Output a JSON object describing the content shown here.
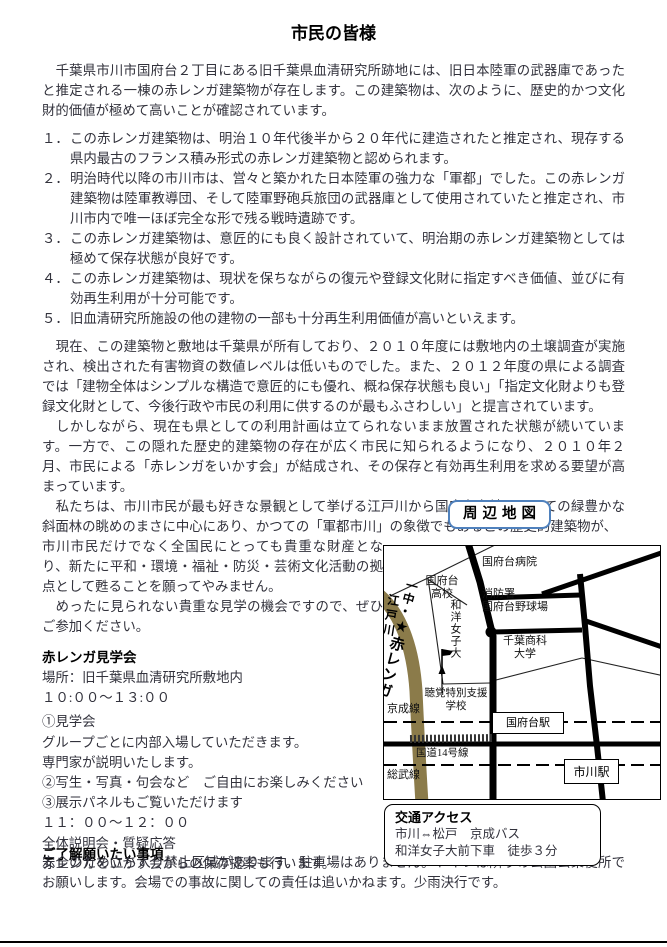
{
  "page": {
    "title": "市民の皆様"
  },
  "intro": "　千葉県市川市国府台２丁目にある旧千葉県血清研究所跡地には、旧日本陸軍の武器庫であったと推定される一棟の赤レンガ建築物が存在します。この建築物は、次のように、歴史的かつ文化財的価値が極めて高いことが確認されています。",
  "points": [
    {
      "num": "１．",
      "text": "この赤レンガ建築物は、明治１０年代後半から２０年代に建造されたと推定され、現存する県内最古のフランス積み形式の赤レンガ建築物と認められます。"
    },
    {
      "num": "２．",
      "text": "明治時代以降の市川市は、営々と築かれた日本陸軍の強力な「軍都」でした。この赤レンガ建築物は陸軍教導団、そして陸軍野砲兵旅団の武器庫として使用されていたと推定され、市川市内で唯一ほぼ完全な形で残る戦時遺跡です。"
    },
    {
      "num": "３．",
      "text": "この赤レンガ建築物は、意匠的にも良く設計されていて、明治期の赤レンガ建築物としては極めて保存状態が良好です。"
    },
    {
      "num": "４．",
      "text": "この赤レンガ建築物は、現状を保ちながらの復元や登録文化財に指定すべき価値、並びに有効再生利用が十分可能です。"
    },
    {
      "num": "５．",
      "text": "旧血清研究所施設の他の建物の一部も十分再生利用価値が高いといえます。"
    }
  ],
  "body": {
    "para_current": "　現在、この建築物と敷地は千葉県が所有しており、２０１０年度には敷地内の土壌調査が実施され、検出された有害物資の数値レベルは低いものでした。また、２０１２年度の県による調査では「建物全体はシンプルな構造で意匠的にも優れ、概ね保存状態も良い」「指定文化財よりも登録文化財として、今後行政や市民の利用に供するのが最もふさわしい」と提言されています。",
    "para_however": "　しかしながら、現在も県としての利用計画は立てられないまま放置された状態が続いています。一方で、この隠れた歴史的建築物の存在が広く市民に知られるようになり、２０１０年２月、市民による「赤レンガをいかす会」が結成され、その保存と有効再生利用を求める要望が高まっています。",
    "para_we_wide": "　私たちは、市川市民が最も好きな景観として挙げる江戸川から国府台台地にかけての緑豊かな斜面林の眺めのまさに中心にあり、かつての「軍都市川」の象徴でもあるこの歴史的建築物が、",
    "para_we_narrow": "市川市民だけでなく全国民にとっても貴重な財産となり、新たに平和・環境・福祉・防災・芸術文化活動の拠点として甦ることを願ってやみません。",
    "para_invite": "　めったに見られない貴重な見学の機会ですので、ぜひご参加ください。"
  },
  "tour": {
    "heading": "赤レンガ見学会",
    "lines": [
      "場所：旧千葉県血清研究所敷地内",
      "１０:００～１３:００",
      "①見学会",
      "グループごとに内部入場していただきます。",
      "専門家が説明いたします。",
      "②写生・写真・句会など　ご自由にお楽しみください",
      "③展示パネルもご覧いただけます",
      "１１：００～１２：００",
      "全体説明会・質疑応答",
      "赤レンガをいかす会からの保存提案も行います。"
    ]
  },
  "notice": {
    "heading": "ご了解願いたい事項",
    "text": "安全のため立ち入り禁止区域があります。駐車場はありません。トイレは隣りの公園公衆便所でお願いします。会場での事故に関しての責任は追いかねます。少雨決行です。"
  },
  "map": {
    "badge": "周辺地図",
    "labels": {
      "edogawa": "江戸川",
      "icchu": "一中・",
      "redbrick": "★赤レンガ",
      "hospital": "国府台病院",
      "highschool": "国府台\n高校",
      "fire_station": "消防署",
      "stadium": "国府台野球場",
      "wayo_univ": "和洋女子大",
      "chiba_univ": "千葉商科\n大学",
      "deaf_school": "聴覚特別支援\n学校",
      "keisei_line": "京成線",
      "konodai_station": "国府台駅",
      "route14": "国道14号線",
      "sobu_line": "総武線",
      "ichikawa_station": "市川駅"
    },
    "icons": {
      "marker": "flag-icon",
      "target": "star-icon"
    }
  },
  "access": {
    "heading": "交通アクセス",
    "line1": "市川⇔松戸　京成バス",
    "line2": "和洋女子大前下車　徒歩３分"
  },
  "colors": {
    "accent_blue": "#4f81bd",
    "river": "#8b7b4a",
    "text": "#32323c"
  }
}
